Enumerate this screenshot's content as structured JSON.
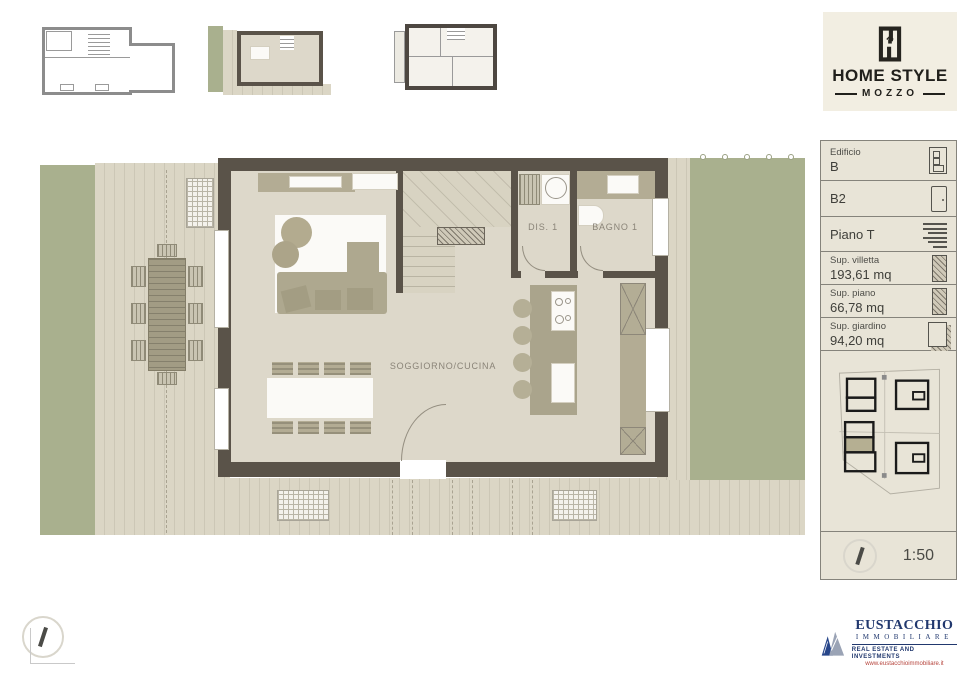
{
  "brand": {
    "name": "HOME STYLE",
    "sub": "MOZZO"
  },
  "info_panel": {
    "building_label": "Edificio",
    "building_value": "B",
    "unit": "B2",
    "floor": "Piano T",
    "villa_area_label": "Sup. villetta",
    "villa_area_value": "193,61 mq",
    "floor_area_label": "Sup. piano",
    "floor_area_value": "66,78 mq",
    "garden_area_label": "Sup. giardino",
    "garden_area_value": "94,20 mq",
    "scale": "1:50"
  },
  "plan": {
    "labels": {
      "living_kitchen": "SOGGIORNO/CUCINA",
      "utility": "DIS. 1",
      "bathroom": "BAGNO 1"
    }
  },
  "agency": {
    "name": "EUSTACCHIO",
    "type": "IMMOBILIARE",
    "tagline": "REAL ESTATE AND INVESTMENTS",
    "website": "www.eustacchioimmobiliare.it"
  },
  "icons": {
    "building": "building-icon",
    "door": "door-icon",
    "floor": "floor-lines-icon",
    "area": "hatched-area-icon",
    "garden": "garden-area-icon",
    "compass": "north-compass-icon"
  },
  "colors": {
    "wall": "#5a5349",
    "floor": "#ddd8ca",
    "grass": "#a9b08e",
    "deck": "#d9d4c3",
    "furniture": "#aea88f",
    "panel_bg": "#e8e4d7",
    "brand_bg": "#f2eee2",
    "agency_blue": "#21386e",
    "agency_red": "#b6443c"
  }
}
